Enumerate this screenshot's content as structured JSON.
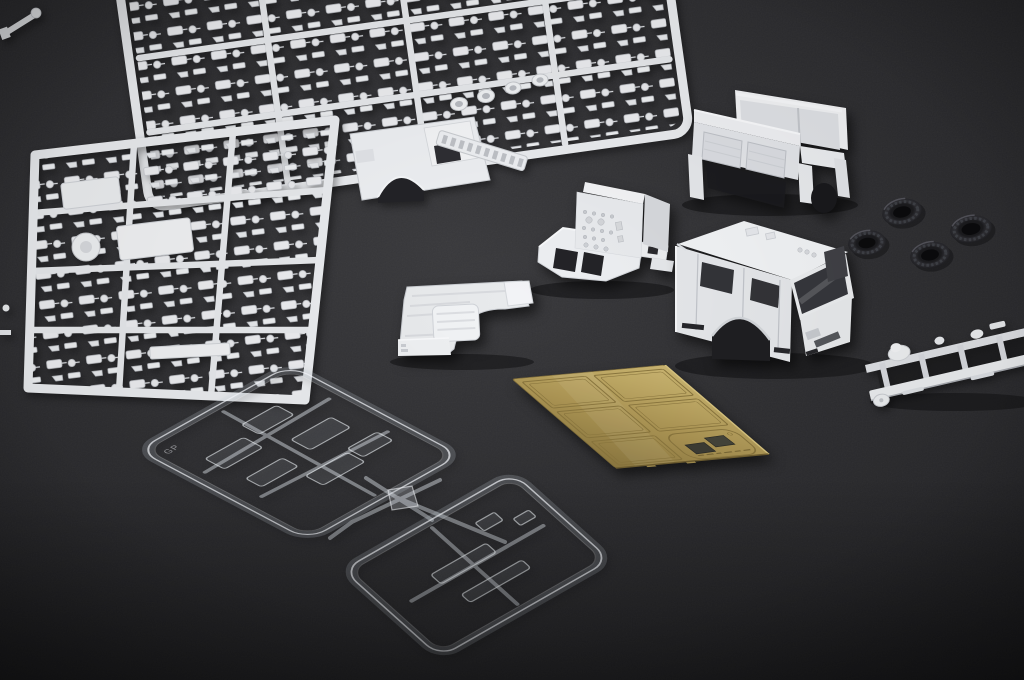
{
  "scene": {
    "title": "Unassembled fire-engine plastic model kit parts laid out on a dark gray surface",
    "description": "Top-down studio photograph of model kit contents: two white styrene part sprues, a white fire-engine cab shell, rear compartment body, pump module with mounting frame, cab interior floor tray, ladder chassis frame, four black rubber tires, a brass photo-etched fret and two clear sprues with window glazing.",
    "surface_color": "#2b2b2e",
    "lighting": "soft studio light from upper left"
  },
  "palette": {
    "white_plastic": "#e9ebee",
    "white_plastic_shade": "#c9ccd1",
    "background": "#2b2b2e",
    "brass": "#b29b5a",
    "brass_dark": "#8a763e",
    "clear_plastic_edge": "#f4f8fc",
    "tire_rubber": "#222226",
    "recess_dark": "#232327"
  },
  "objects": {
    "runner_stub": {
      "label": "Cut sprue runner end at top-left corner"
    },
    "sprue_top": {
      "label": "White styrene sprue with cab side panel, ladder and small fittings"
    },
    "sprue_left": {
      "label": "White styrene sprue dense with chassis and body detail parts"
    },
    "rear_body": {
      "label": "White rear compartment body with shutter doors and open top"
    },
    "pump_module": {
      "label": "White pump module with gauge panel and flat mounting frame"
    },
    "cab_shell": {
      "label": "White fire-engine cab shell with open windshield and window cutouts"
    },
    "interior_tray": {
      "label": "Cab interior floor tray with raised engine cover"
    },
    "chassis": {
      "label": "White ladder chassis frame with axle and spring detail, cut off at right edge"
    },
    "tires": {
      "label": "Black rubber tires with tread",
      "count": 4
    },
    "photoetch": {
      "label": "Brass photo-etched fret with rectangular panels and two dark slotted pieces",
      "panel_count": 5,
      "marking": "illegible etched part numbers along lower edge"
    },
    "clear_sprue_upper": {
      "label": "Clear sprue holding cab window glazing pieces",
      "marking": "GP"
    },
    "clear_sprue_lower": {
      "label": "Clear sprue with light lenses, windshield strip and cross runner"
    }
  }
}
